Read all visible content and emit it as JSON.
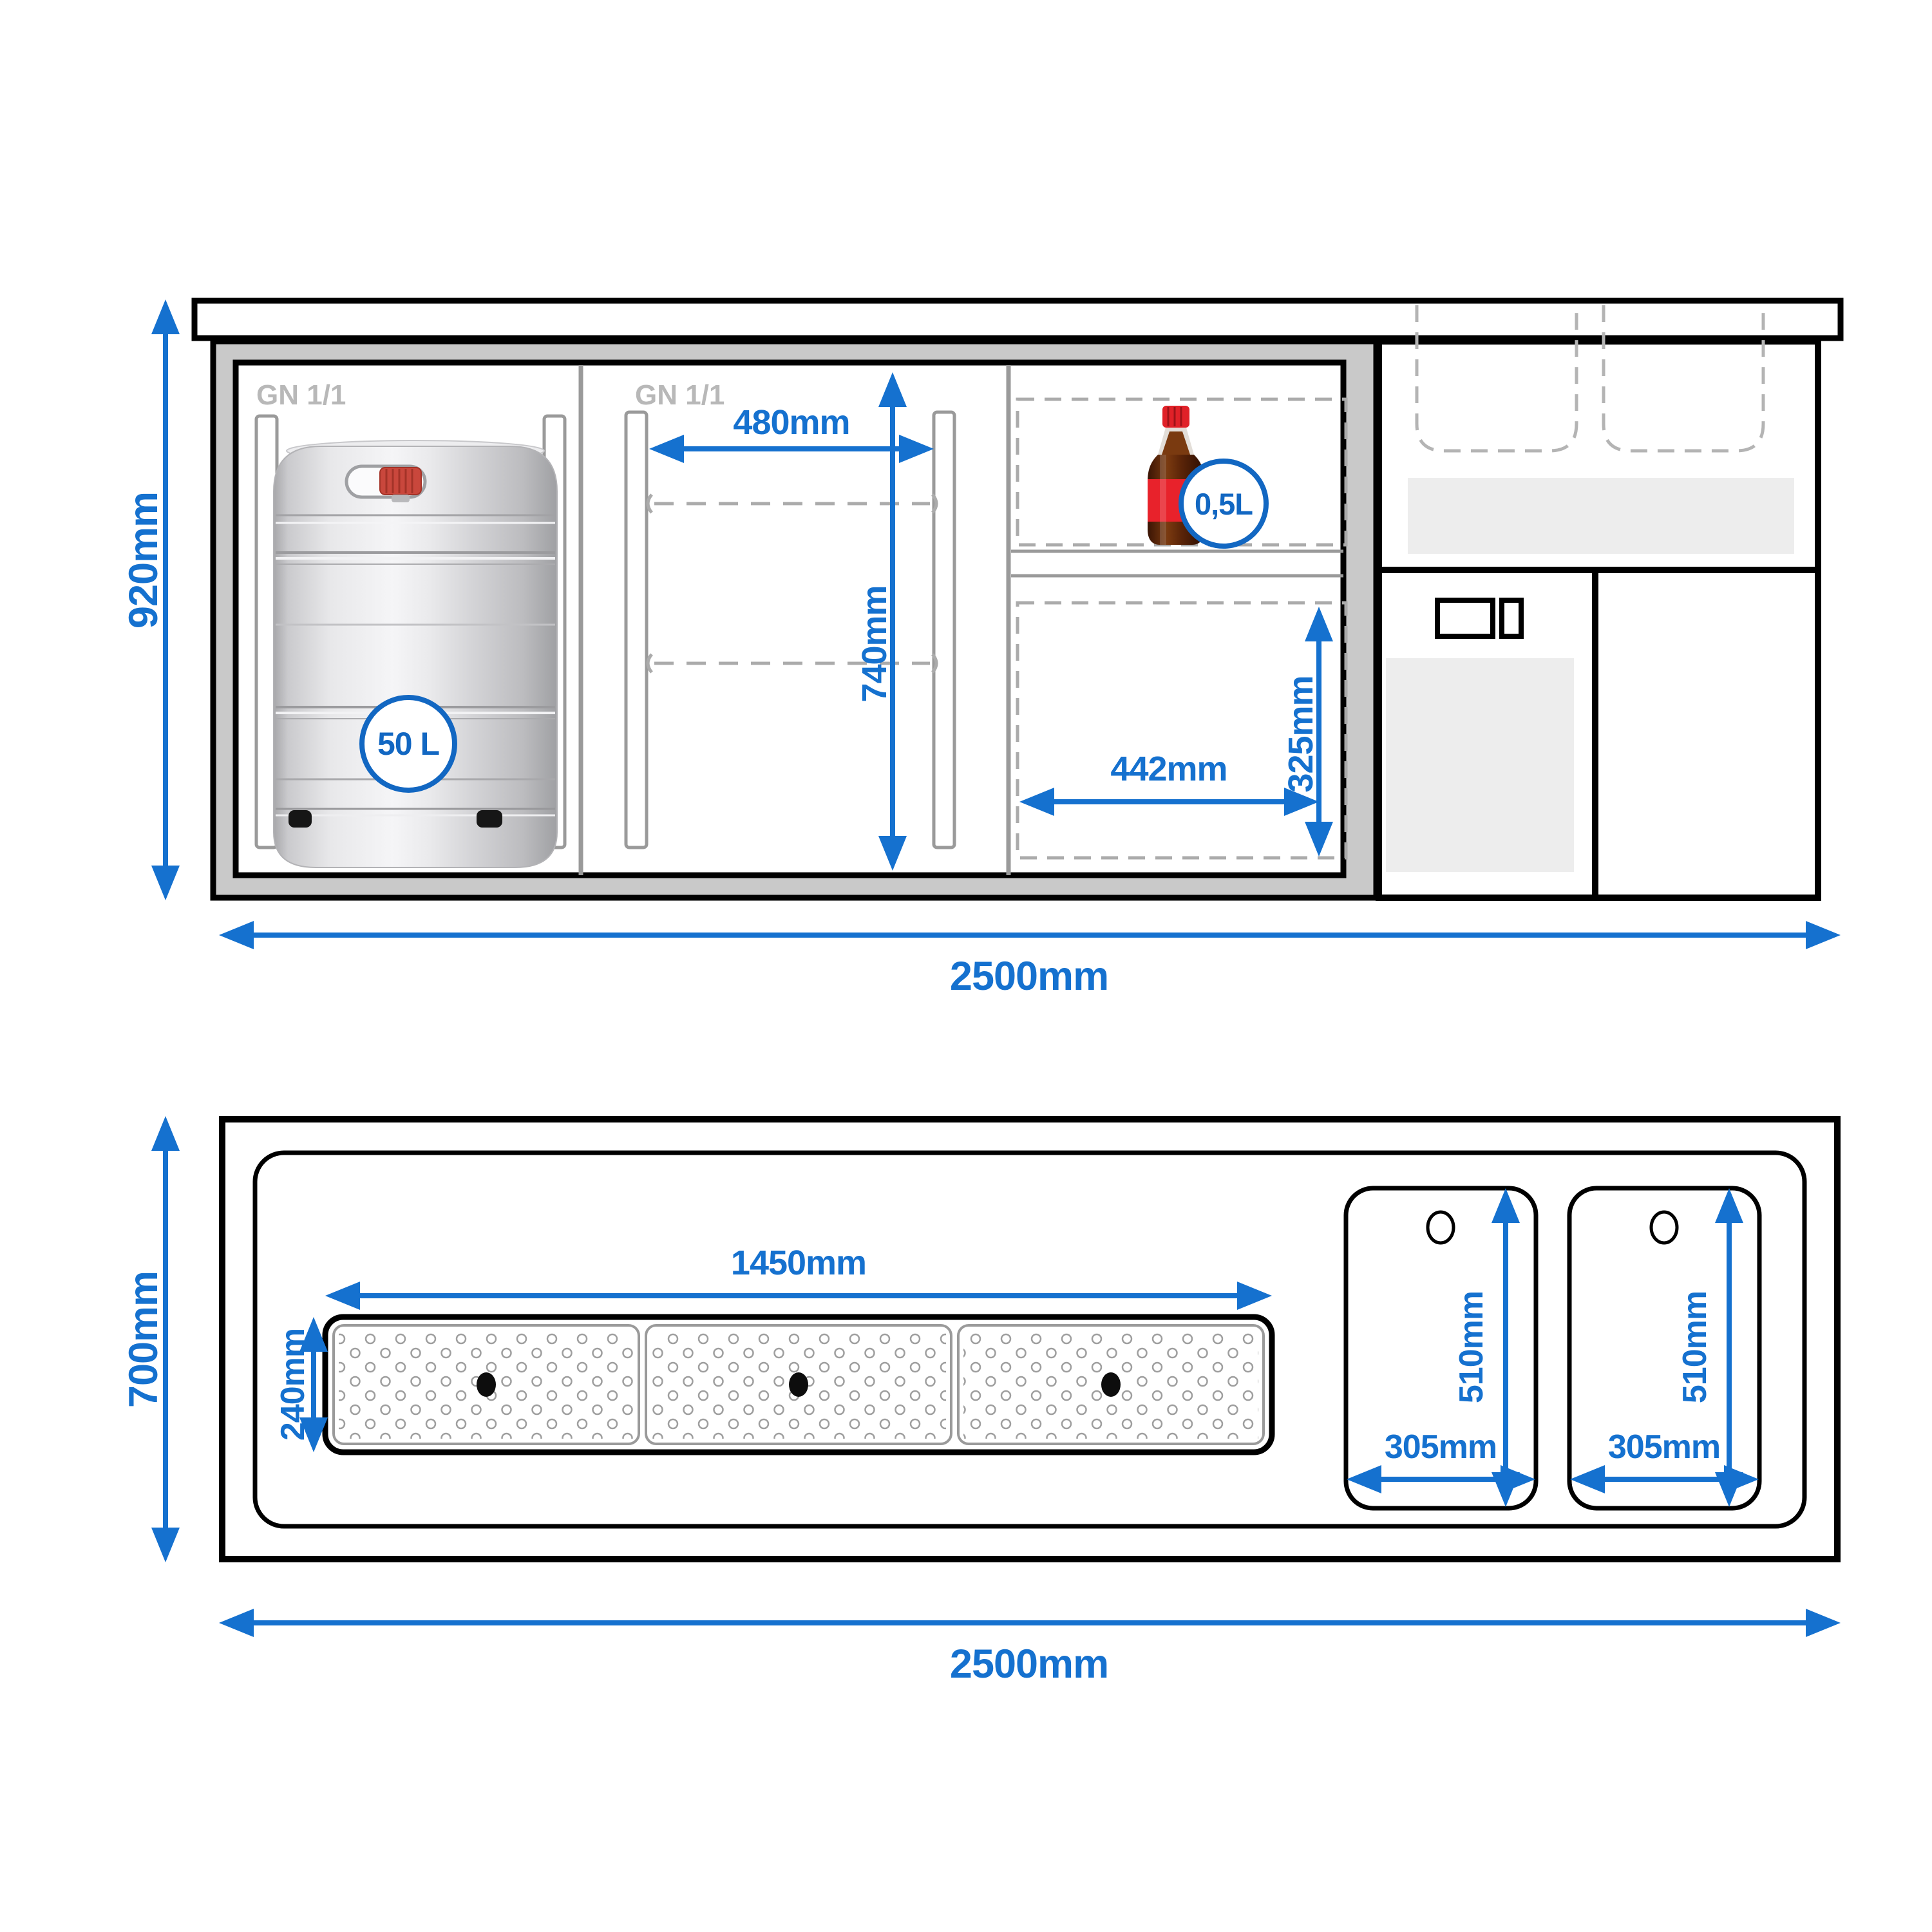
{
  "diagram": {
    "front_view": {
      "height_label": "920mm",
      "width_label": "2500mm",
      "gn_label_left": "GN 1/1",
      "gn_label_middle": "GN 1/1",
      "keg_capacity": "50 L",
      "inner_width_label": "480mm",
      "inner_height_label": "740mm",
      "bottle_capacity": "0,5L",
      "lower_shelf_width_label": "442mm",
      "lower_shelf_height_label": "325mm"
    },
    "top_view": {
      "depth_label": "700mm",
      "width_label": "2500mm",
      "drip_tray": {
        "width_label": "1450mm",
        "depth_label": "240mm"
      },
      "sinks": [
        {
          "width_label": "305mm",
          "depth_label": "510mm"
        },
        {
          "width_label": "305mm",
          "depth_label": "510mm"
        }
      ]
    },
    "colors": {
      "dimension_blue": "#1571cf",
      "badge_blue": "#1267c2",
      "frame_gray": "#c9c9c9",
      "panel_gray": "#ededed",
      "line_gray": "#9a9a9a",
      "dashed_gray": "#ababab",
      "gn_label_gray": "#b8b8b8",
      "bottle_red": "#e8222b",
      "keg_silver": "#d9d9db"
    }
  }
}
